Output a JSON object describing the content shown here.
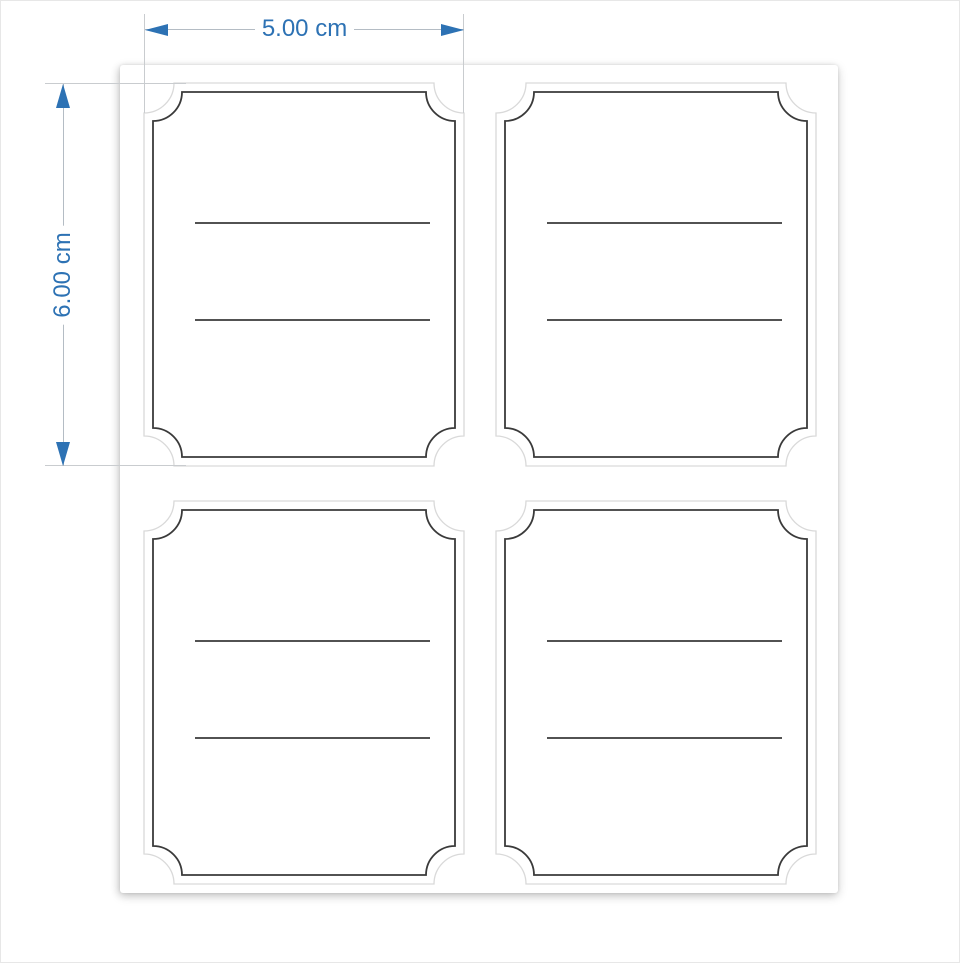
{
  "dimensions": {
    "width": {
      "label": "5.00 cm"
    },
    "height": {
      "label": "6.00 cm"
    }
  },
  "sheet": {
    "rows": 2,
    "columns": 2,
    "label_count": 4,
    "writing_lines_per_label": 2
  },
  "colors": {
    "dimension_accent": "#2D72B4",
    "dimension_line": "#B4BCC4",
    "extension_line": "#C9CCCF",
    "die_cut_line": "#D9D9D9",
    "printed_border": "#3A3A3A",
    "writing_line": "#3A3A3A",
    "sheet_background": "#FFFFFF",
    "page_background": "#FFFFFF"
  }
}
